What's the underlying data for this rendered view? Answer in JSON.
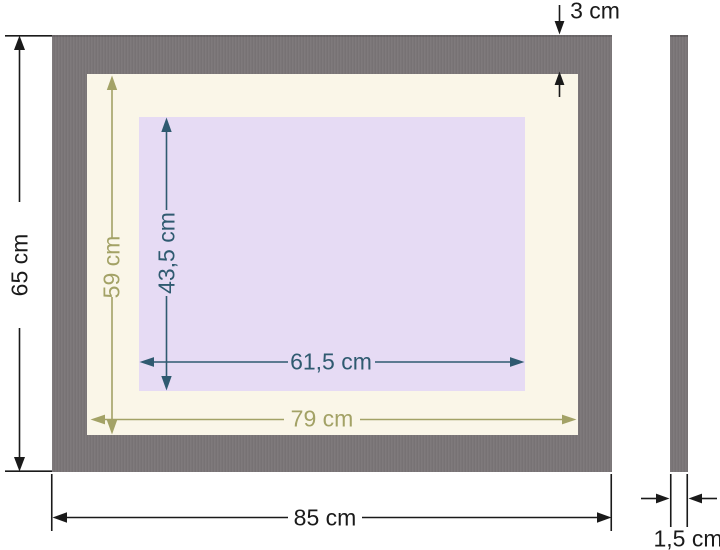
{
  "colors": {
    "background": "#ffffff",
    "frame": "#7b7678",
    "mat": "#faf6e8",
    "opening": "#e6dbf4",
    "dim-primary": "#1a1a1a",
    "dim-mat": "#a3a266",
    "dim-opening": "#2f5a70"
  },
  "front_view": {
    "frame_thickness_label": "3 cm",
    "outer_height_label": "65 cm",
    "outer_width_label": "85 cm",
    "mat_height_label": "59 cm",
    "mat_width_label": "79 cm",
    "opening_width_label": "61,5 cm",
    "opening_height_label": "43,5 cm"
  },
  "side_view": {
    "depth_label": "1,5 cm"
  }
}
